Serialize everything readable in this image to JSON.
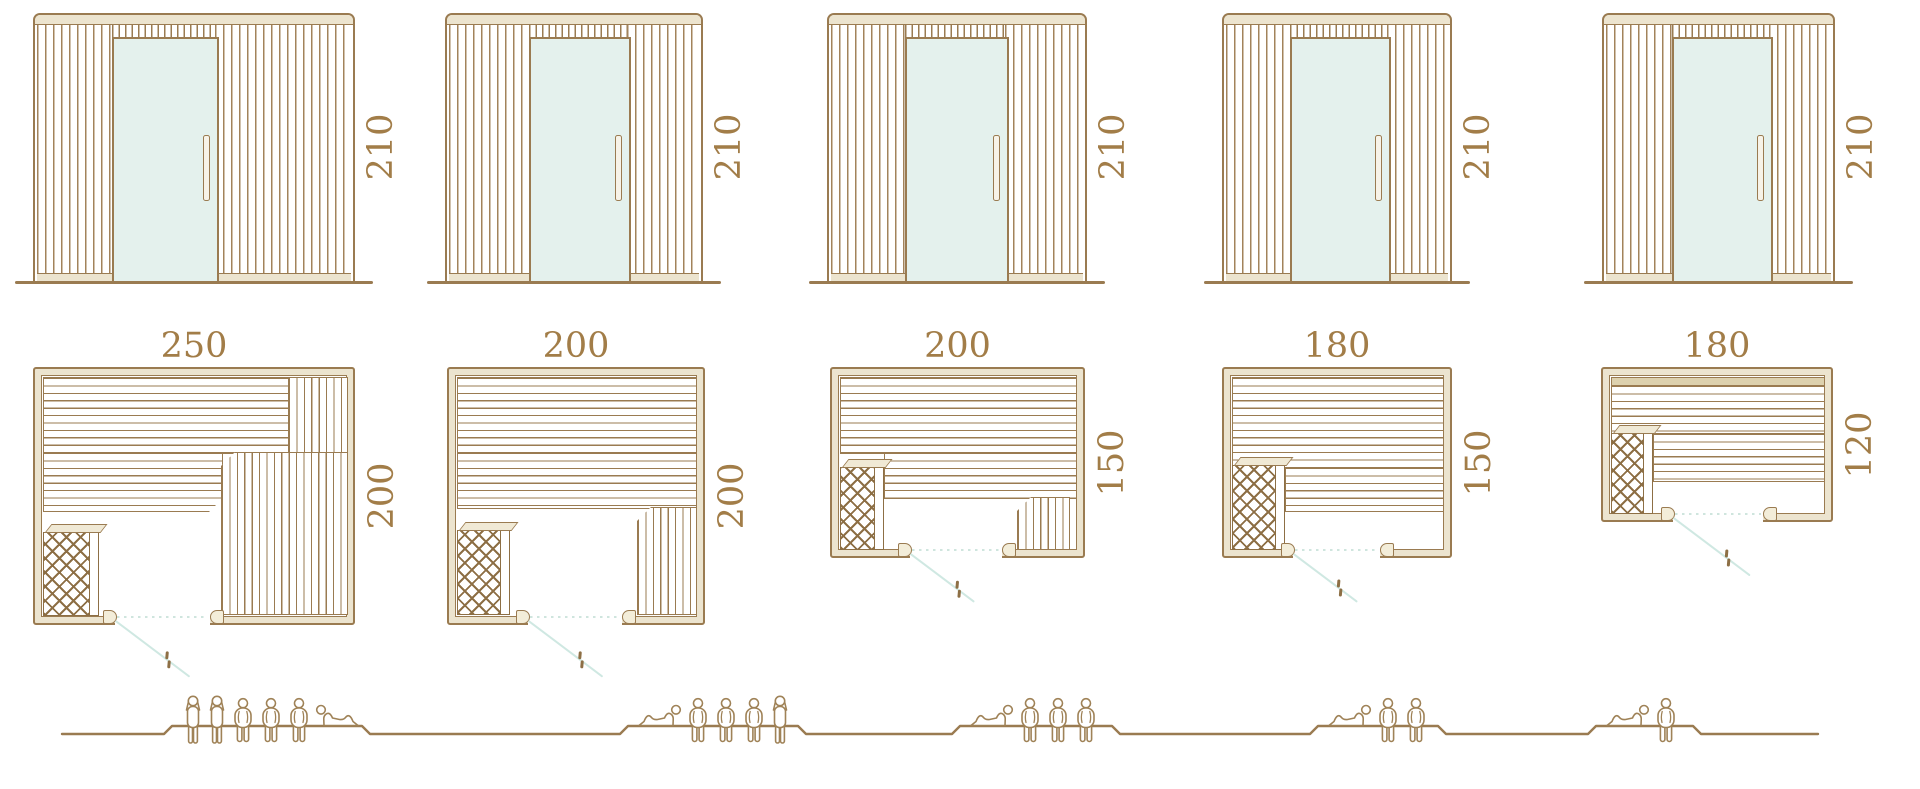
{
  "diagram": {
    "description": "Sauna cabin size chart: five models with front elevations, floor plans and seating capacity",
    "colors": {
      "line_brown": "#9a7b51",
      "wall_fill": "#ece4cf",
      "glass_mint": "#e4f1ed",
      "door_swing": "#cfe8e2",
      "label_text": "#a27d48",
      "heater_dark": "#8d6f45"
    }
  },
  "models": [
    {
      "height": "210",
      "width": "250",
      "depth": "200",
      "capacity": {
        "standing": 2,
        "sitting": 3,
        "lying": 1
      },
      "figures": [
        "standing",
        "standing",
        "sitting",
        "sitting",
        "sitting",
        "lying-head-left"
      ]
    },
    {
      "height": "210",
      "width": "200",
      "depth": "200",
      "capacity": {
        "standing": 1,
        "sitting": 3,
        "lying": 1
      },
      "figures": [
        "lying-head-right",
        "sitting",
        "sitting",
        "sitting",
        "standing"
      ]
    },
    {
      "height": "210",
      "width": "200",
      "depth": "150",
      "capacity": {
        "standing": 0,
        "sitting": 3,
        "lying": 1
      },
      "figures": [
        "lying-head-right",
        "sitting",
        "sitting",
        "sitting"
      ]
    },
    {
      "height": "210",
      "width": "180",
      "depth": "150",
      "capacity": {
        "standing": 0,
        "sitting": 2,
        "lying": 1
      },
      "figures": [
        "lying-head-right",
        "sitting",
        "sitting"
      ]
    },
    {
      "height": "210",
      "width": "180",
      "depth": "120",
      "capacity": {
        "standing": 0,
        "sitting": 1,
        "lying": 1
      },
      "figures": [
        "lying-head-right",
        "sitting"
      ]
    }
  ]
}
